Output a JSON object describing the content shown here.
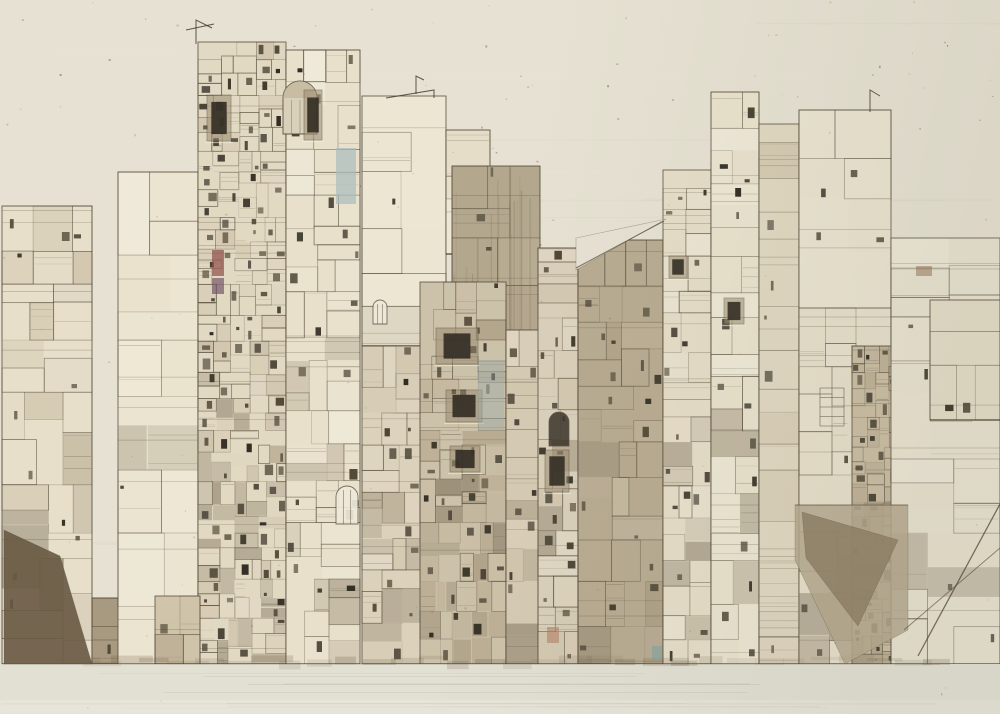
{
  "artwork": {
    "kind": "sepia architectural collage drawing of dense city towers",
    "accent_colors": [
      "#8e4f49",
      "#6d4f63",
      "#a9bcbd",
      "#9fb0ad",
      "#b07a5e",
      "#7fa3a4"
    ]
  },
  "scene": {
    "w": 1000,
    "h": 714,
    "seed": 11,
    "line": "#4a4130",
    "paper": {
      "base": "#e6e1d2",
      "dark": "#c9c4b2",
      "light": "#f0ece0",
      "speck": "#6b604c",
      "streaks": 26,
      "specks": 150,
      "topspecks": 70
    },
    "tint": {
      "c": "#787860",
      "o": 0.1
    },
    "ground": {
      "y": 664,
      "f": "#e2e0d3",
      "y2": 700,
      "f2": "#e7e5d9",
      "shadow": "#6b5b44",
      "line": "#5a4c38"
    },
    "tonesets": {
      "light": [
        "#efe9d8",
        "#ece5d2",
        "#e9e1cc",
        "#f1ecdd"
      ],
      "mid": [
        "#ddd3bf",
        "#d5cab3",
        "#cdc1a7",
        "#e2d9c6"
      ],
      "warm": [
        "#c0b298",
        "#b6a88d",
        "#aa9c81",
        "#cabda4"
      ],
      "brown": [
        "#8f8169",
        "#7b6d56",
        "#695d48"
      ],
      "dark": [
        "#4e4534",
        "#3e382b",
        "#2f2a21"
      ]
    },
    "blocks": [
      {
        "x": 2,
        "y": 206,
        "w": 90,
        "h": 458,
        "f": "#e7dfca",
        "ts": "mid",
        "d": 0.62
      },
      {
        "x": 92,
        "y": 598,
        "w": 28,
        "h": 66,
        "f": "#a89a80",
        "ts": "brown",
        "d": 0.75
      },
      {
        "x": 118,
        "y": 172,
        "w": 80,
        "h": 492,
        "f": "#ebe4d0",
        "ts": "light",
        "d": 0.16
      },
      {
        "x": 198,
        "y": 42,
        "w": 88,
        "h": 622,
        "f": "#e2d9c3",
        "ts": "mid",
        "d": 0.97
      },
      {
        "x": 286,
        "y": 50,
        "w": 74,
        "h": 614,
        "f": "#e8e0cb",
        "ts": "light",
        "d": 0.8
      },
      {
        "x": 362,
        "y": 96,
        "w": 84,
        "h": 250,
        "f": "#ece6d3",
        "ts": "light",
        "d": 0.15
      },
      {
        "x": 446,
        "y": 130,
        "w": 44,
        "h": 124,
        "f": "#e5ddc7",
        "ts": "light",
        "d": 0.4
      },
      {
        "x": 452,
        "y": 166,
        "w": 88,
        "h": 498,
        "f": "#b3a78e",
        "ts": "warm",
        "d": 0.45,
        "st": true
      },
      {
        "x": 362,
        "y": 346,
        "w": 60,
        "h": 318,
        "f": "#dcd2bc",
        "ts": "mid",
        "d": 0.85
      },
      {
        "x": 420,
        "y": 282,
        "w": 86,
        "h": 382,
        "f": "#ccc1a9",
        "ts": "warm",
        "d": 0.9
      },
      {
        "x": 506,
        "y": 330,
        "w": 34,
        "h": 334,
        "f": "#d5cab3",
        "ts": "mid",
        "d": 0.8
      },
      {
        "x": 538,
        "y": 248,
        "w": 40,
        "h": 416,
        "f": "#d9cfba",
        "ts": "mid",
        "d": 0.85
      },
      {
        "x": 578,
        "y": 240,
        "w": 85,
        "h": 424,
        "f": "#b8ab92",
        "ts": "warm",
        "d": 0.7
      },
      {
        "x": 663,
        "y": 170,
        "w": 48,
        "h": 494,
        "f": "#e6ddc8",
        "ts": "light",
        "d": 0.85
      },
      {
        "x": 711,
        "y": 92,
        "w": 48,
        "h": 572,
        "f": "#e9e2cd",
        "ts": "light",
        "d": 0.72
      },
      {
        "x": 759,
        "y": 124,
        "w": 40,
        "h": 540,
        "f": "#e1d8c2",
        "ts": "mid",
        "d": 0.55
      },
      {
        "x": 799,
        "y": 110,
        "w": 92,
        "h": 200,
        "f": "#eae4d1",
        "ts": "light",
        "d": 0.2
      },
      {
        "x": 799,
        "y": 308,
        "w": 92,
        "h": 356,
        "f": "#e6dfcb",
        "ts": "light",
        "d": 0.66
      },
      {
        "x": 852,
        "y": 346,
        "w": 76,
        "h": 318,
        "f": "#cabda4",
        "ts": "warm",
        "d": 1.0
      },
      {
        "x": 891,
        "y": 238,
        "w": 109,
        "h": 426,
        "f": "#e8e2d1",
        "ts": "light",
        "d": 0.4
      },
      {
        "x": 930,
        "y": 300,
        "w": 70,
        "h": 120,
        "f": "#e4ddc9",
        "ts": "light",
        "d": 0.45
      },
      {
        "x": 155,
        "y": 596,
        "w": 45,
        "h": 68,
        "f": "#cfc3a9",
        "ts": "mid",
        "d": 0.85
      }
    ],
    "features": [
      {
        "t": "wedge",
        "p": [
          [
            4,
            530
          ],
          [
            60,
            556
          ],
          [
            92,
            664
          ],
          [
            4,
            664
          ]
        ],
        "f": "#6a5a44",
        "o": 0.9
      },
      {
        "t": "wedge",
        "p": [
          [
            576,
            238
          ],
          [
            666,
            219
          ],
          [
            576,
            270
          ]
        ],
        "f": "#e6e1d2",
        "o": 1
      },
      {
        "t": "line",
        "p": [
          [
            576,
            268
          ],
          [
            664,
            221
          ]
        ],
        "w": 1,
        "o": 0.7
      },
      {
        "t": "wedge",
        "p": [
          [
            795,
            505
          ],
          [
            908,
            505
          ],
          [
            908,
            630
          ],
          [
            845,
            664
          ],
          [
            795,
            560
          ]
        ],
        "f": "#b5a88e",
        "o": 0.85
      },
      {
        "t": "wedge",
        "p": [
          [
            802,
            512
          ],
          [
            898,
            540
          ],
          [
            858,
            626
          ],
          [
            806,
            558
          ]
        ],
        "f": "#8c7c62",
        "o": 0.8
      },
      {
        "t": "line",
        "p": [
          [
            918,
            656
          ],
          [
            1000,
            504
          ]
        ],
        "w": 1.3,
        "o": 0.75
      },
      {
        "t": "line",
        "p": [
          [
            904,
            630
          ],
          [
            1000,
            548
          ]
        ],
        "w": 1,
        "o": 0.6
      },
      {
        "t": "line",
        "p": [
          [
            795,
            505
          ],
          [
            908,
            505
          ]
        ],
        "w": 1,
        "o": 0.6
      },
      {
        "t": "dome",
        "cx": 300,
        "cy": 98,
        "r": 17,
        "b": 134
      },
      {
        "t": "arch",
        "x": 336,
        "y": 486,
        "w": 22,
        "h": 38,
        "dark": false
      },
      {
        "t": "arch",
        "x": 549,
        "y": 412,
        "w": 20,
        "h": 34,
        "dark": true
      },
      {
        "t": "arch",
        "x": 373,
        "y": 300,
        "w": 14,
        "h": 24,
        "dark": false
      },
      {
        "t": "win",
        "x": 207,
        "y": 95,
        "w": 24,
        "h": 46
      },
      {
        "t": "win",
        "x": 304,
        "y": 90,
        "w": 18,
        "h": 50
      },
      {
        "t": "win",
        "x": 436,
        "y": 328,
        "w": 42,
        "h": 36
      },
      {
        "t": "win",
        "x": 446,
        "y": 390,
        "w": 36,
        "h": 32
      },
      {
        "t": "win",
        "x": 450,
        "y": 446,
        "w": 30,
        "h": 26
      },
      {
        "t": "win",
        "x": 545,
        "y": 450,
        "w": 24,
        "h": 42
      },
      {
        "t": "win",
        "x": 669,
        "y": 256,
        "w": 18,
        "h": 22
      },
      {
        "t": "win",
        "x": 724,
        "y": 298,
        "w": 20,
        "h": 26
      },
      {
        "t": "accent",
        "x": 212,
        "y": 250,
        "w": 12,
        "h": 26,
        "f": "#8e4f49",
        "o": 0.7
      },
      {
        "t": "accent",
        "x": 212,
        "y": 278,
        "w": 12,
        "h": 16,
        "f": "#6d4f63",
        "o": 0.65
      },
      {
        "t": "accent",
        "x": 336,
        "y": 148,
        "w": 20,
        "h": 56,
        "f": "#a9bcbd",
        "o": 0.7
      },
      {
        "t": "accent",
        "x": 478,
        "y": 360,
        "w": 26,
        "h": 70,
        "f": "#9fb0ad",
        "o": 0.45
      },
      {
        "t": "accent",
        "x": 547,
        "y": 627,
        "w": 12,
        "h": 16,
        "f": "#b07a5e",
        "o": 0.55
      },
      {
        "t": "accent",
        "x": 652,
        "y": 646,
        "w": 10,
        "h": 14,
        "f": "#7fa3a4",
        "o": 0.6
      },
      {
        "t": "accent",
        "x": 916,
        "y": 266,
        "w": 16,
        "h": 10,
        "f": "#8e6a4e",
        "o": 0.5
      },
      {
        "t": "rail",
        "x": 820,
        "y": 388,
        "w": 24,
        "h": 38,
        "n": 4
      },
      {
        "t": "ant",
        "p": [
          [
            196,
            44
          ],
          [
            196,
            20
          ],
          [
            212,
            28
          ]
        ]
      },
      {
        "t": "ant",
        "p": [
          [
            186,
            30
          ],
          [
            214,
            24
          ]
        ]
      },
      {
        "t": "ant",
        "p": [
          [
            386,
            98
          ],
          [
            434,
            90
          ],
          [
            434,
            98
          ]
        ]
      },
      {
        "t": "ant",
        "p": [
          [
            416,
            94
          ],
          [
            416,
            76
          ],
          [
            424,
            80
          ]
        ]
      },
      {
        "t": "ant",
        "p": [
          [
            870,
            112
          ],
          [
            870,
            90
          ],
          [
            880,
            96
          ]
        ]
      }
    ]
  }
}
